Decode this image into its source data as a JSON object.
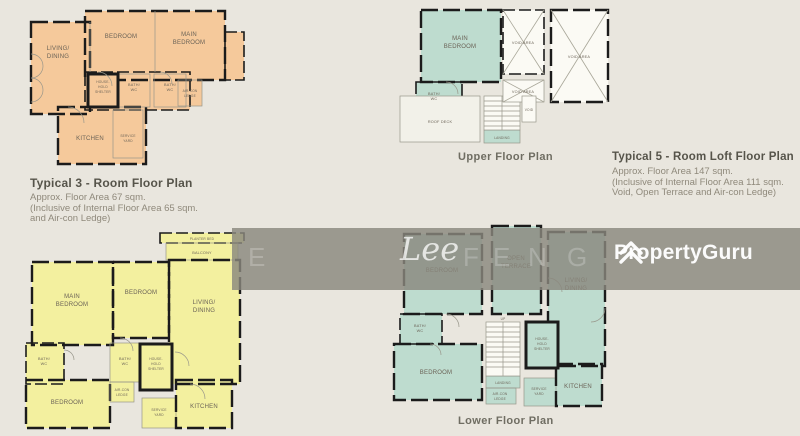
{
  "colors": {
    "bg": "#e9e6de",
    "orange": "#f5c99b",
    "yellow": "#f3f09f",
    "teal": "#bedccf",
    "wall": "#1b1b1b",
    "label": "#6b6357",
    "caption_title": "#56544a",
    "caption_text": "#8f897b",
    "band": "#8a8880"
  },
  "captions": {
    "typical3": {
      "title": "Typical 3 - Room Floor Plan",
      "line1": "Approx. Floor Area 67 sqm.",
      "line2": "(Inclusive of Internal Floor Area 65 sqm.",
      "line3": "and Air-con Ledge)"
    },
    "typical5": {
      "title": "Typical 5 - Room Loft Floor Plan",
      "line1": "Approx. Floor Area 147 sqm.",
      "line2": "(Inclusive of Internal Floor Area 111 sqm.",
      "line3": "Void, Open Terrace and Air-con Ledge)"
    },
    "upper": "Upper Floor Plan",
    "lower": "Lower Floor Plan"
  },
  "plan_typical3": {
    "living": [
      "LIVING/",
      "DINING"
    ],
    "bedroom": [
      "BEDROOM"
    ],
    "main_bedroom": [
      "MAIN",
      "BEDROOM"
    ],
    "household": [
      "HOUSE-",
      "HOLD",
      "SHELTER"
    ],
    "bath1": [
      "BATH/",
      "WC"
    ],
    "bath2": [
      "BATH/",
      "WC"
    ],
    "aircon": [
      "AIR-CON",
      "LEDGE"
    ],
    "kitchen": [
      "KITCHEN"
    ],
    "service": [
      "SERVICE",
      "YARD"
    ]
  },
  "plan_4room": {
    "planter": [
      "PLANTER BED"
    ],
    "balcony": [
      "BALCONY"
    ],
    "main_bedroom": [
      "MAIN",
      "BEDROOM"
    ],
    "bedroom_top": [
      "BEDROOM"
    ],
    "living": [
      "LIVING/",
      "DINING"
    ],
    "bath_left": [
      "BATH/",
      "WC"
    ],
    "bedroom_bottom": [
      "BEDROOM"
    ],
    "bath_mid": [
      "BATH/",
      "WC"
    ],
    "household": [
      "HOUSE-",
      "HOLD",
      "SHELTER"
    ],
    "aircon": [
      "AIR-CON",
      "LEDGE"
    ],
    "service": [
      "SERVICE",
      "YARD"
    ],
    "kitchen": [
      "KITCHEN"
    ]
  },
  "plan_upper": {
    "main_bedroom": [
      "MAIN",
      "BEDROOM"
    ],
    "bath": [
      "BATH/",
      "WC"
    ],
    "void1": [
      "VOID AREA"
    ],
    "void2": [
      "VOID AREA"
    ],
    "void3": [
      "VOID AREA"
    ],
    "void4": [
      "VOID"
    ],
    "roof_deck": [
      "ROOF DECK"
    ],
    "landing": [
      "LANDING"
    ]
  },
  "plan_lower": {
    "bedroom_top": [
      "BEDROOM"
    ],
    "terrace": [
      "OPEN",
      "TERRACE"
    ],
    "living": [
      "LIVING/",
      "DINING"
    ],
    "bath": [
      "BATH/",
      "WC"
    ],
    "bedroom_bottom": [
      "BEDROOM"
    ],
    "up": [
      "UP"
    ],
    "landing": [
      "LANDING"
    ],
    "household": [
      "HOUSE-",
      "HOLD",
      "SHELTER"
    ],
    "aircon": [
      "AIR-CON",
      "LEDGE"
    ],
    "service": [
      "SERVICE",
      "YARD"
    ],
    "kitchen": [
      "KITCHEN"
    ]
  },
  "watermark": {
    "letters": [
      "E",
      "F",
      "E",
      "N",
      "G"
    ],
    "script": "Lee",
    "brand": "PropertyGuru"
  }
}
